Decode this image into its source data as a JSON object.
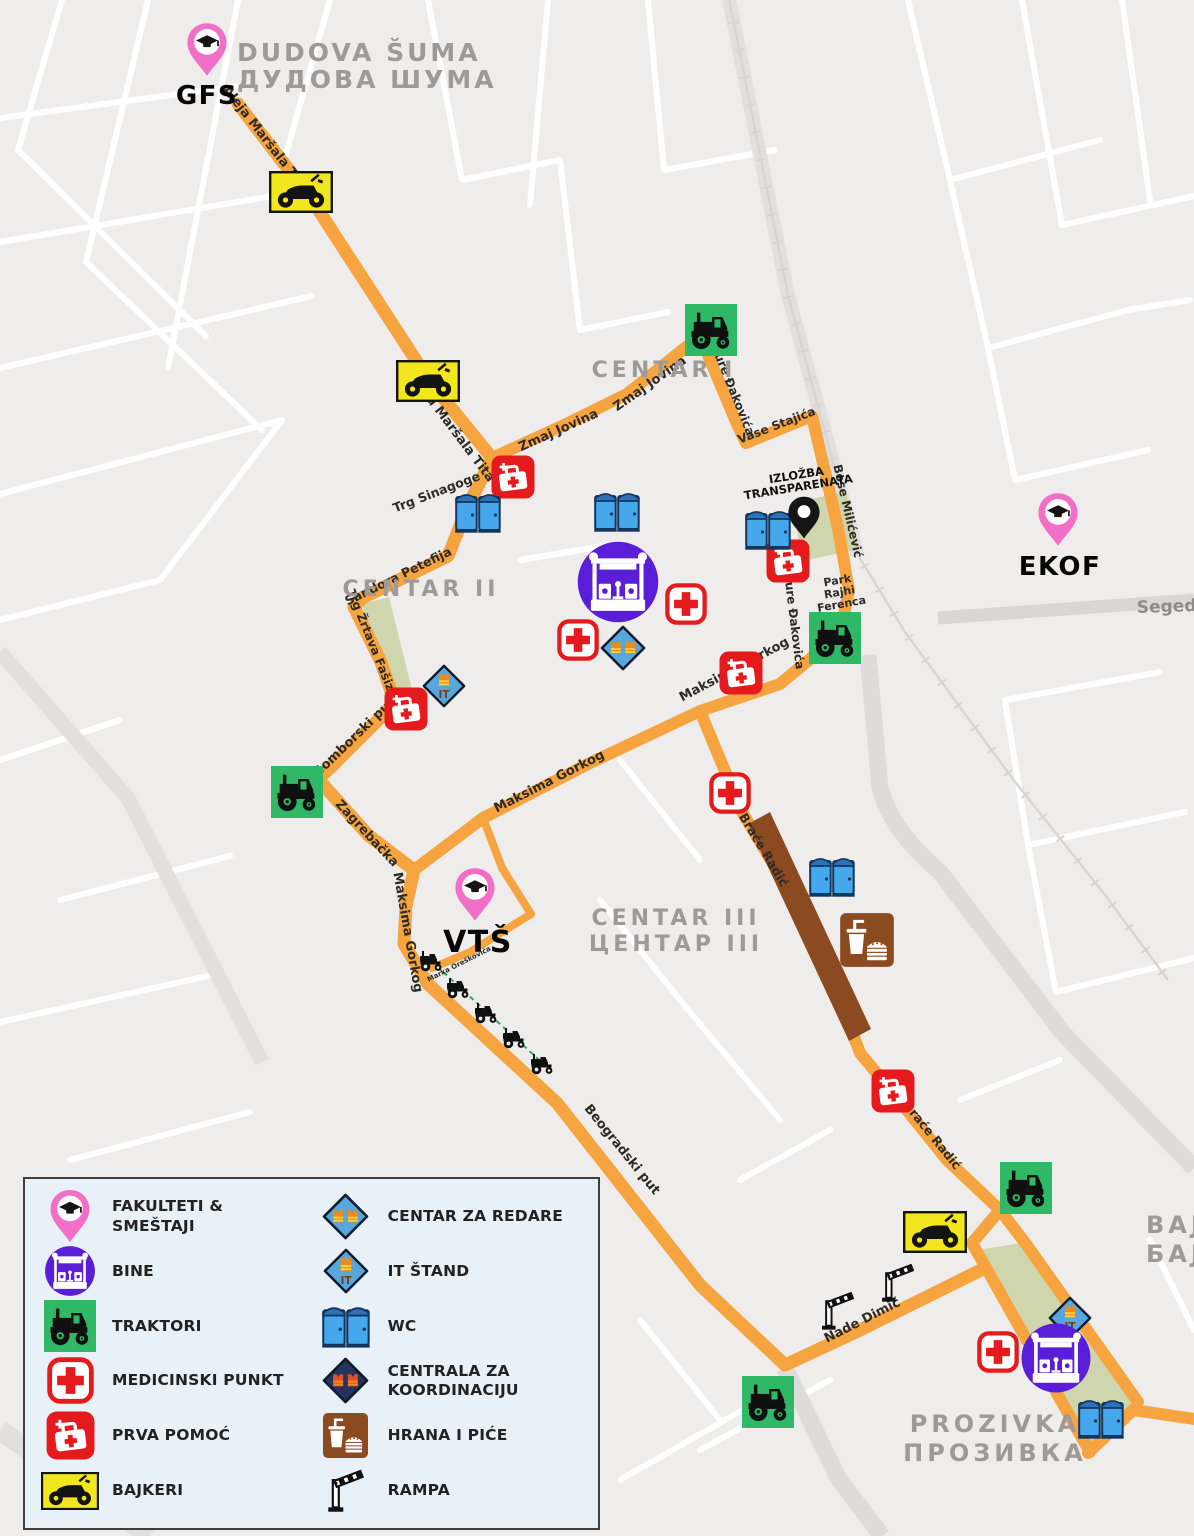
{
  "map": {
    "pins": {
      "gfs": "GFS",
      "ekof": "EKOF",
      "vts": "VTŠ",
      "izlozba_l1": "IZLOŽBA",
      "izlozba_l2": "TRANSPARENATA"
    },
    "areas": {
      "dudova_l1": "DUDOVA ŠUMA",
      "dudova_l2": "ДУДОВА ШУМА",
      "centar1": "CENTAR I",
      "centar2": "CENTAR II",
      "centar3_l1": "CENTAR III",
      "centar3_l2": "ЦЕНТАР III",
      "prozivka_l1": "PROZIVKA",
      "prozivka_l2": "ПРОЗИВКА",
      "baj_l1": "BAJ",
      "baj_l2": "БАЈ",
      "seged": "Seged"
    },
    "streets": {
      "amt1": "Aleja Maršala Tita",
      "amt2": "Aleja Maršala Tita",
      "zmaj1": "Zmaj Jovina",
      "zmaj2": "Zmaj Jovina",
      "djure1": "Đure Đakovića",
      "djure2": "Đure Đakovića",
      "vase": "Vase Stajića",
      "bose": "Bose Milićević",
      "trg_sinagoge": "Trg Sinagoge",
      "sandora": "Sandora Petefija",
      "trg_zrtava": "Trg Žrtava Fašizma",
      "somborski": "Somborski put",
      "zagrebacka": "Zagrebačka",
      "maksima1": "Maksima Gorkog",
      "maksima2": "Maksima Gorkog",
      "maksima3": "Maksima Gorkog",
      "marka": "Marka Oreškovića",
      "brace1": "Braće Radić",
      "brace2": "Braće Radić",
      "beogradski": "Beogradski put",
      "nade": "Nade Dimić",
      "park_l1": "Park",
      "park_l2": "Rajhi",
      "park_l3": "Ferenca"
    }
  },
  "icons": {
    "it_label": "IT"
  },
  "legend": {
    "items": [
      {
        "id": "fakulteti",
        "label": "FAKULTETI & SMEŠTAJI"
      },
      {
        "id": "bine",
        "label": "BINE"
      },
      {
        "id": "traktori",
        "label": "TRAKTORI"
      },
      {
        "id": "medicinski",
        "label": "MEDICINSKI PUNKT"
      },
      {
        "id": "prva-pomoc",
        "label": "PRVA POMOĆ"
      },
      {
        "id": "bajkeri",
        "label": "BAJKERI"
      },
      {
        "id": "centar-za-redare",
        "label": "CENTAR ZA REDARE"
      },
      {
        "id": "it-stand",
        "label": "IT ŠTAND"
      },
      {
        "id": "wc",
        "label": "WC"
      },
      {
        "id": "centrala",
        "label": "CENTRALA ZA",
        "label2": "KOORDINACIJU"
      },
      {
        "id": "hrana",
        "label": "HRANA I PIĆE"
      },
      {
        "id": "rampa",
        "label": "RAMPA"
      }
    ]
  },
  "colors": {
    "route": "#F5A43F",
    "tractor_green": "#2FB966",
    "stage_purple": "#5B1ED8",
    "pin_pink": "#F16FC6",
    "alert_red": "#E51A1C",
    "biker_yellow": "#F2E71E",
    "wc_blue": "#45A8EC",
    "diamond_blue": "#57A6DC",
    "diamond_navy": "#26335C",
    "food_brown": "#8C4A20",
    "park_green": "#CBD3A6",
    "map_bg": "#EFEDEC"
  }
}
